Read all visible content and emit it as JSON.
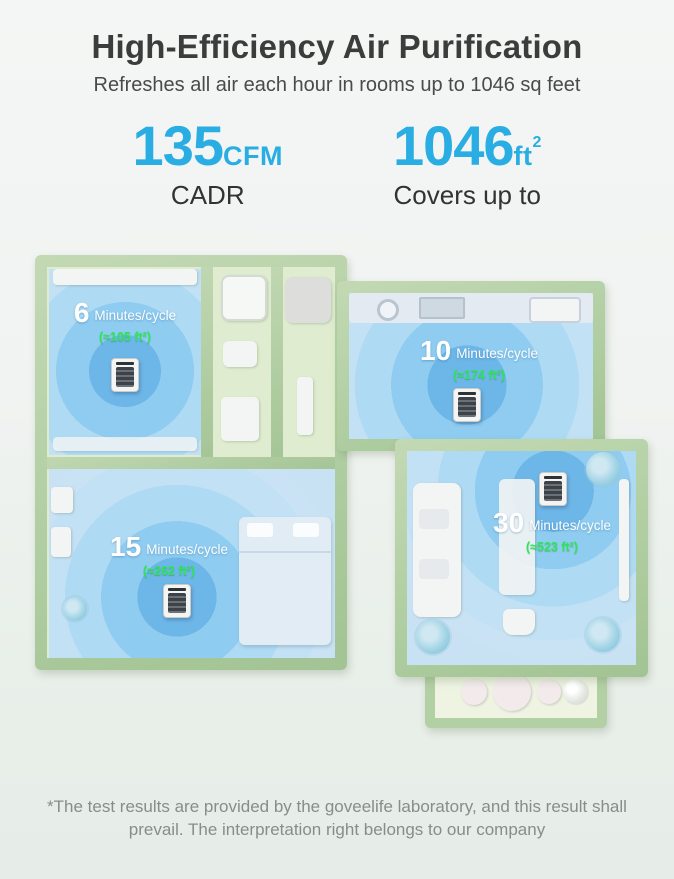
{
  "header": {
    "title": "High-Efficiency Air Purification",
    "subtitle": "Refreshes all air each hour in rooms up to 1046 sq feet"
  },
  "stats": {
    "cadr": {
      "value": "135",
      "unit": "CFM",
      "label": "CADR"
    },
    "coverage": {
      "value": "1046",
      "unit": "ft",
      "sup": "2",
      "label": "Covers up to"
    }
  },
  "floorplan": {
    "rooms": [
      {
        "name": "small-bedroom",
        "minutes": "6",
        "cycle": "Minutes/cycle",
        "area": "(≈105 ft²)"
      },
      {
        "name": "kitchen",
        "minutes": "10",
        "cycle": "Minutes/cycle",
        "area": "(≈174 ft²)"
      },
      {
        "name": "master-bedroom",
        "minutes": "15",
        "cycle": "Minutes/cycle",
        "area": "(≈262 ft²)"
      },
      {
        "name": "living-room",
        "minutes": "30",
        "cycle": "Minutes/cycle",
        "area": "(≈523 ft²)"
      }
    ]
  },
  "footer": {
    "disclaimer": "*The test results are provided by the goveelife laboratory, and this result shall prevail. The interpretation right belongs to our company"
  },
  "colors": {
    "accent_blue": "#29ade3",
    "area_green": "#2ee558",
    "wall_green": "#aecda0",
    "floor_green": "#dfeccf",
    "coverage_blue": "#2f98e0"
  }
}
